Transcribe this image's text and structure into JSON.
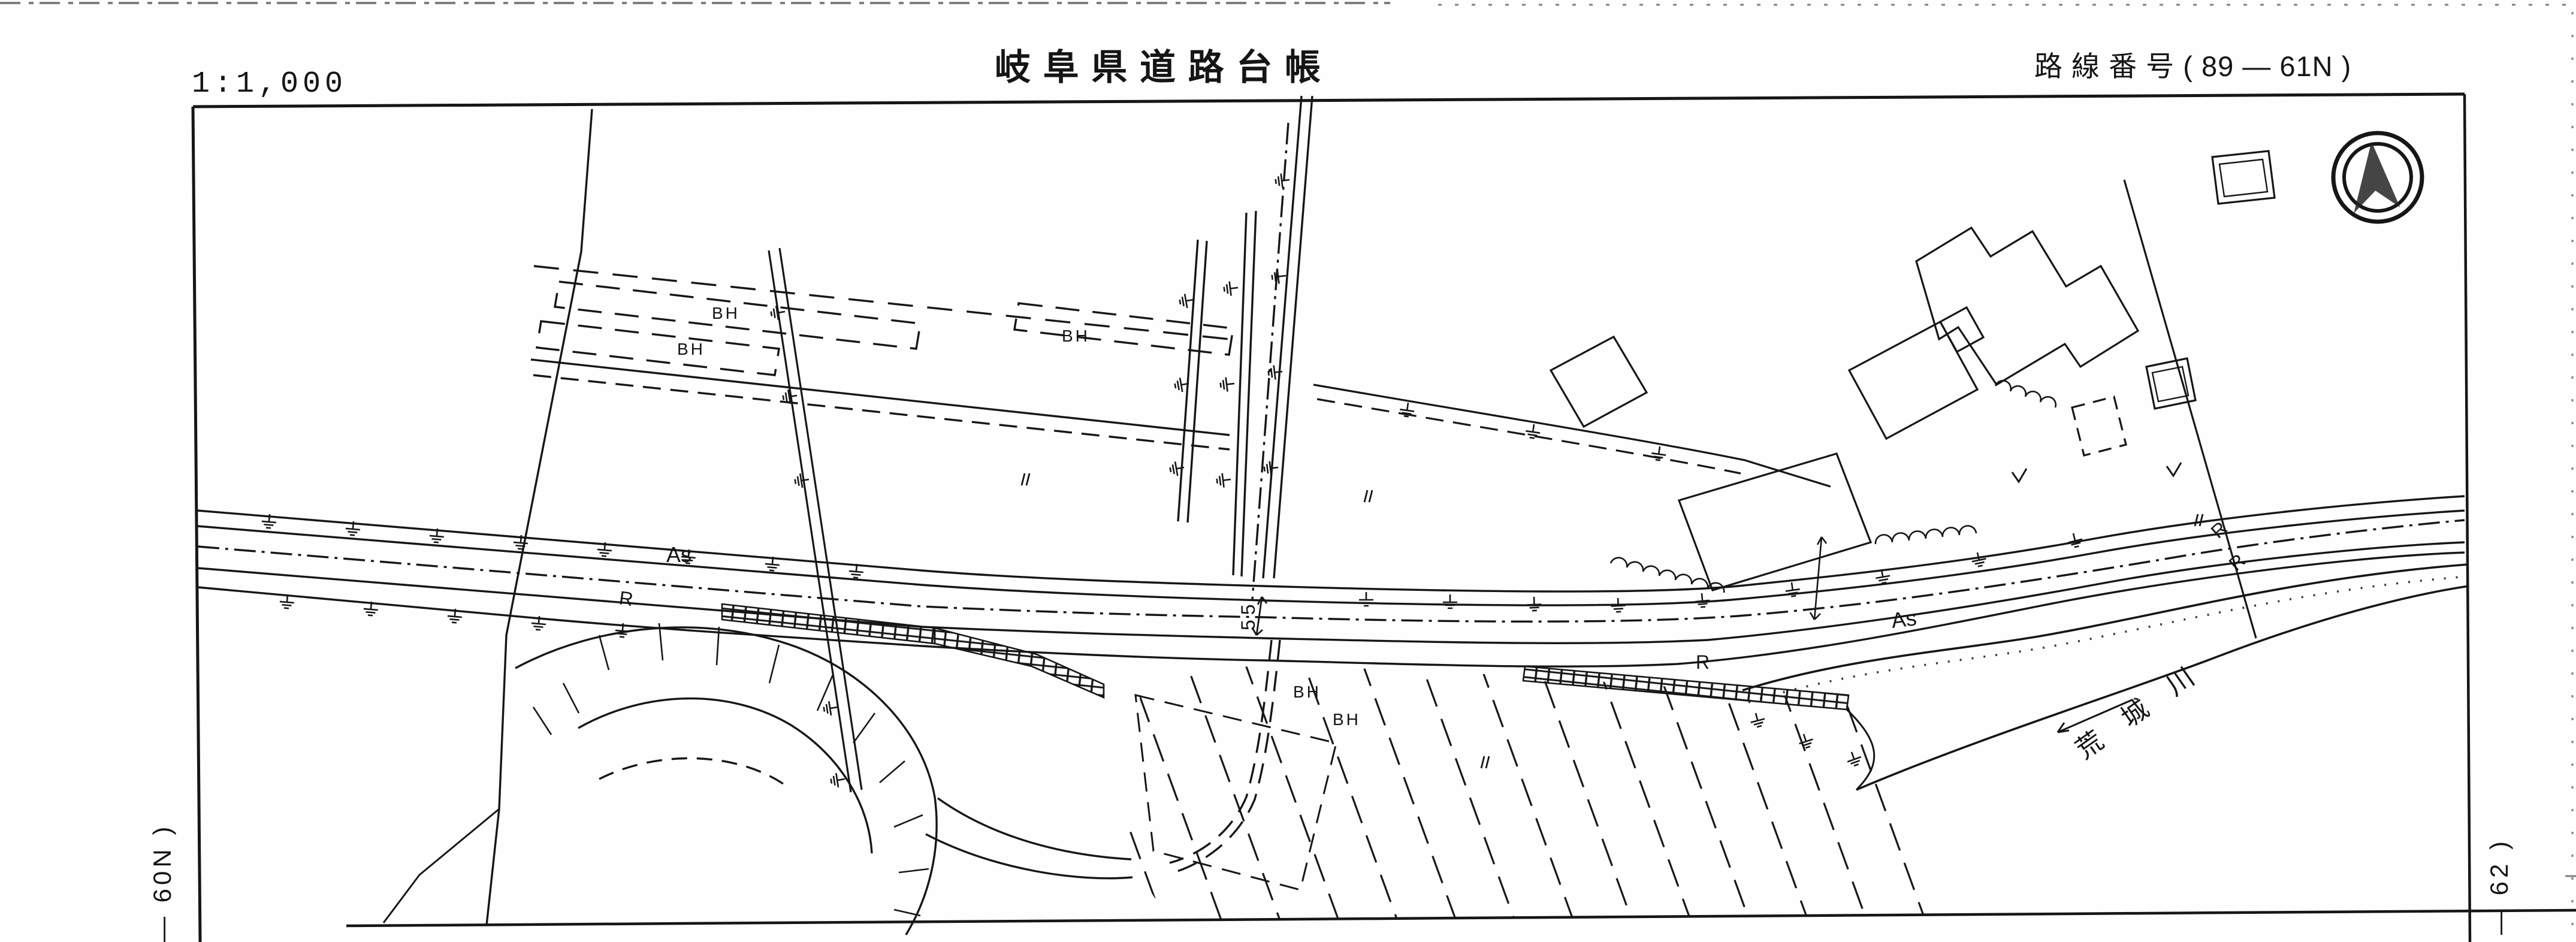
{
  "header": {
    "scale": "1:1,000",
    "title": "岐 阜 県 道 路 台 帳",
    "route_label": "路 線 番 号 (  89    —    61N  )"
  },
  "sheet_refs": {
    "left_adjacent": "—  60N  )",
    "right_adjacent": "—  62  )"
  },
  "map": {
    "surface_labels": {
      "as_left": "As",
      "as_right": "As"
    },
    "roadside_labels": {
      "r_left": "R",
      "r_mid": "R",
      "r_ne_upper": "R",
      "r_ne_lower": "R"
    },
    "structure_labels": {
      "bh_1": "BH",
      "bh_2": "BH",
      "bh_3": "BH",
      "bh_4": "BH",
      "bh_5": "BH"
    },
    "station_label": "55",
    "river_name": "荒 城 川"
  },
  "icons": {
    "compass": "north-arrow-compass"
  },
  "colors": {
    "ink": "#161616",
    "paper": "#fefefe"
  }
}
